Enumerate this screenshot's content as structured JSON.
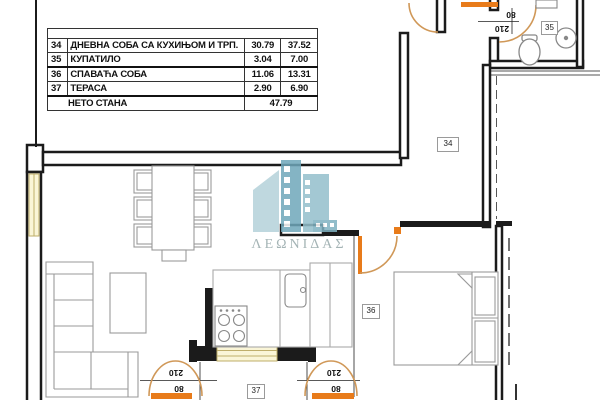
{
  "table": {
    "rows": [
      {
        "num": "34",
        "name": "ДНЕВНА СОБА СА КУХИЊОМ И ТРП.",
        "area_net": "30.79",
        "area_gross": "37.52"
      },
      {
        "num": "35",
        "name": "КУПАТИЛО",
        "area_net": "3.04",
        "area_gross": "7.00"
      },
      {
        "num": "36",
        "name": "СПАВАЋА СОБА",
        "area_net": "11.06",
        "area_gross": "13.31"
      },
      {
        "num": "37",
        "name": "ТЕРАСА",
        "area_net": "2.90",
        "area_gross": "6.90"
      }
    ],
    "total_label": "НЕТО СТАНА",
    "total_value": "47.79"
  },
  "room_labels": {
    "living_room": "34",
    "bathroom": "35",
    "bedroom": "36",
    "terrace": "37"
  },
  "door_dimensions": {
    "height": "210",
    "width": "80"
  },
  "watermark": {
    "text": "ΛΕΩΝΙΔΑΣ"
  },
  "colors": {
    "wall": "#1b1b1b",
    "door_leaf": "#e87b1a",
    "door_arc": "#d09858",
    "window_fill": "#faf5d7",
    "window_border": "#bfae6a",
    "furniture_line": "#9a9a9a",
    "logo_teal": "#6fa7ba",
    "logo_text": "#95a7a9"
  }
}
